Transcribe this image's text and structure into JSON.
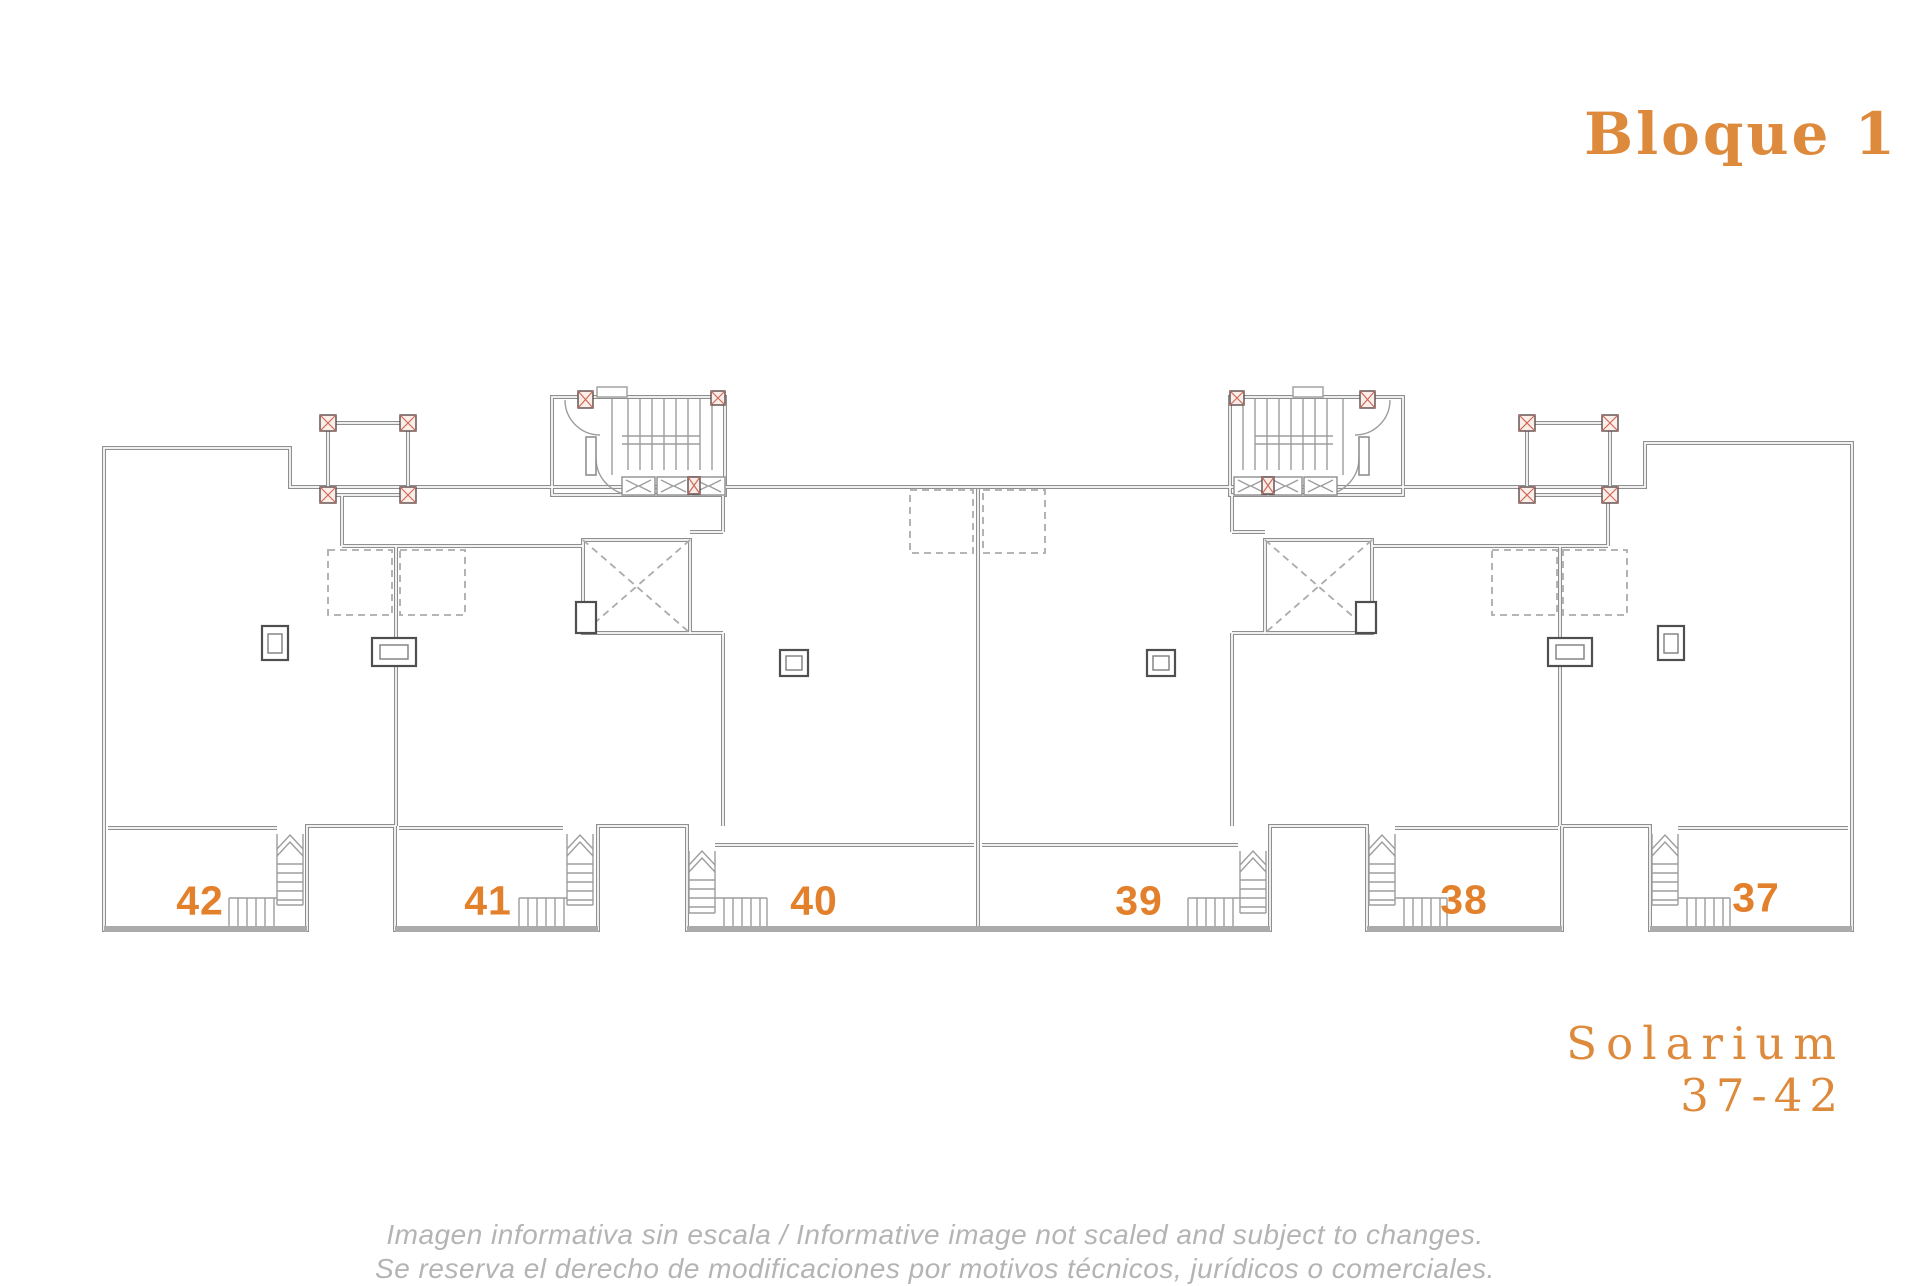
{
  "title": "Bloque 1",
  "units": [
    {
      "number": "42"
    },
    {
      "number": "41"
    },
    {
      "number": "40"
    },
    {
      "number": "39"
    },
    {
      "number": "38"
    },
    {
      "number": "37"
    }
  ],
  "solarium": {
    "line1": "Solarium",
    "line2": "37-42"
  },
  "disclaimer": {
    "line1": "Imagen informativa sin escala /  Informative image not scaled and subject to changes.",
    "line2": "Se reserva el derecho de modificaciones por motivos técnicos, jurídicos o comerciales."
  },
  "colors": {
    "accent_title": "#dd8a3c",
    "unit_number": "#e3802b",
    "plan_line": "#8f8f8f",
    "post_hatch": "#cc6a5a",
    "disclaimer_text": "#b4b4b4"
  }
}
